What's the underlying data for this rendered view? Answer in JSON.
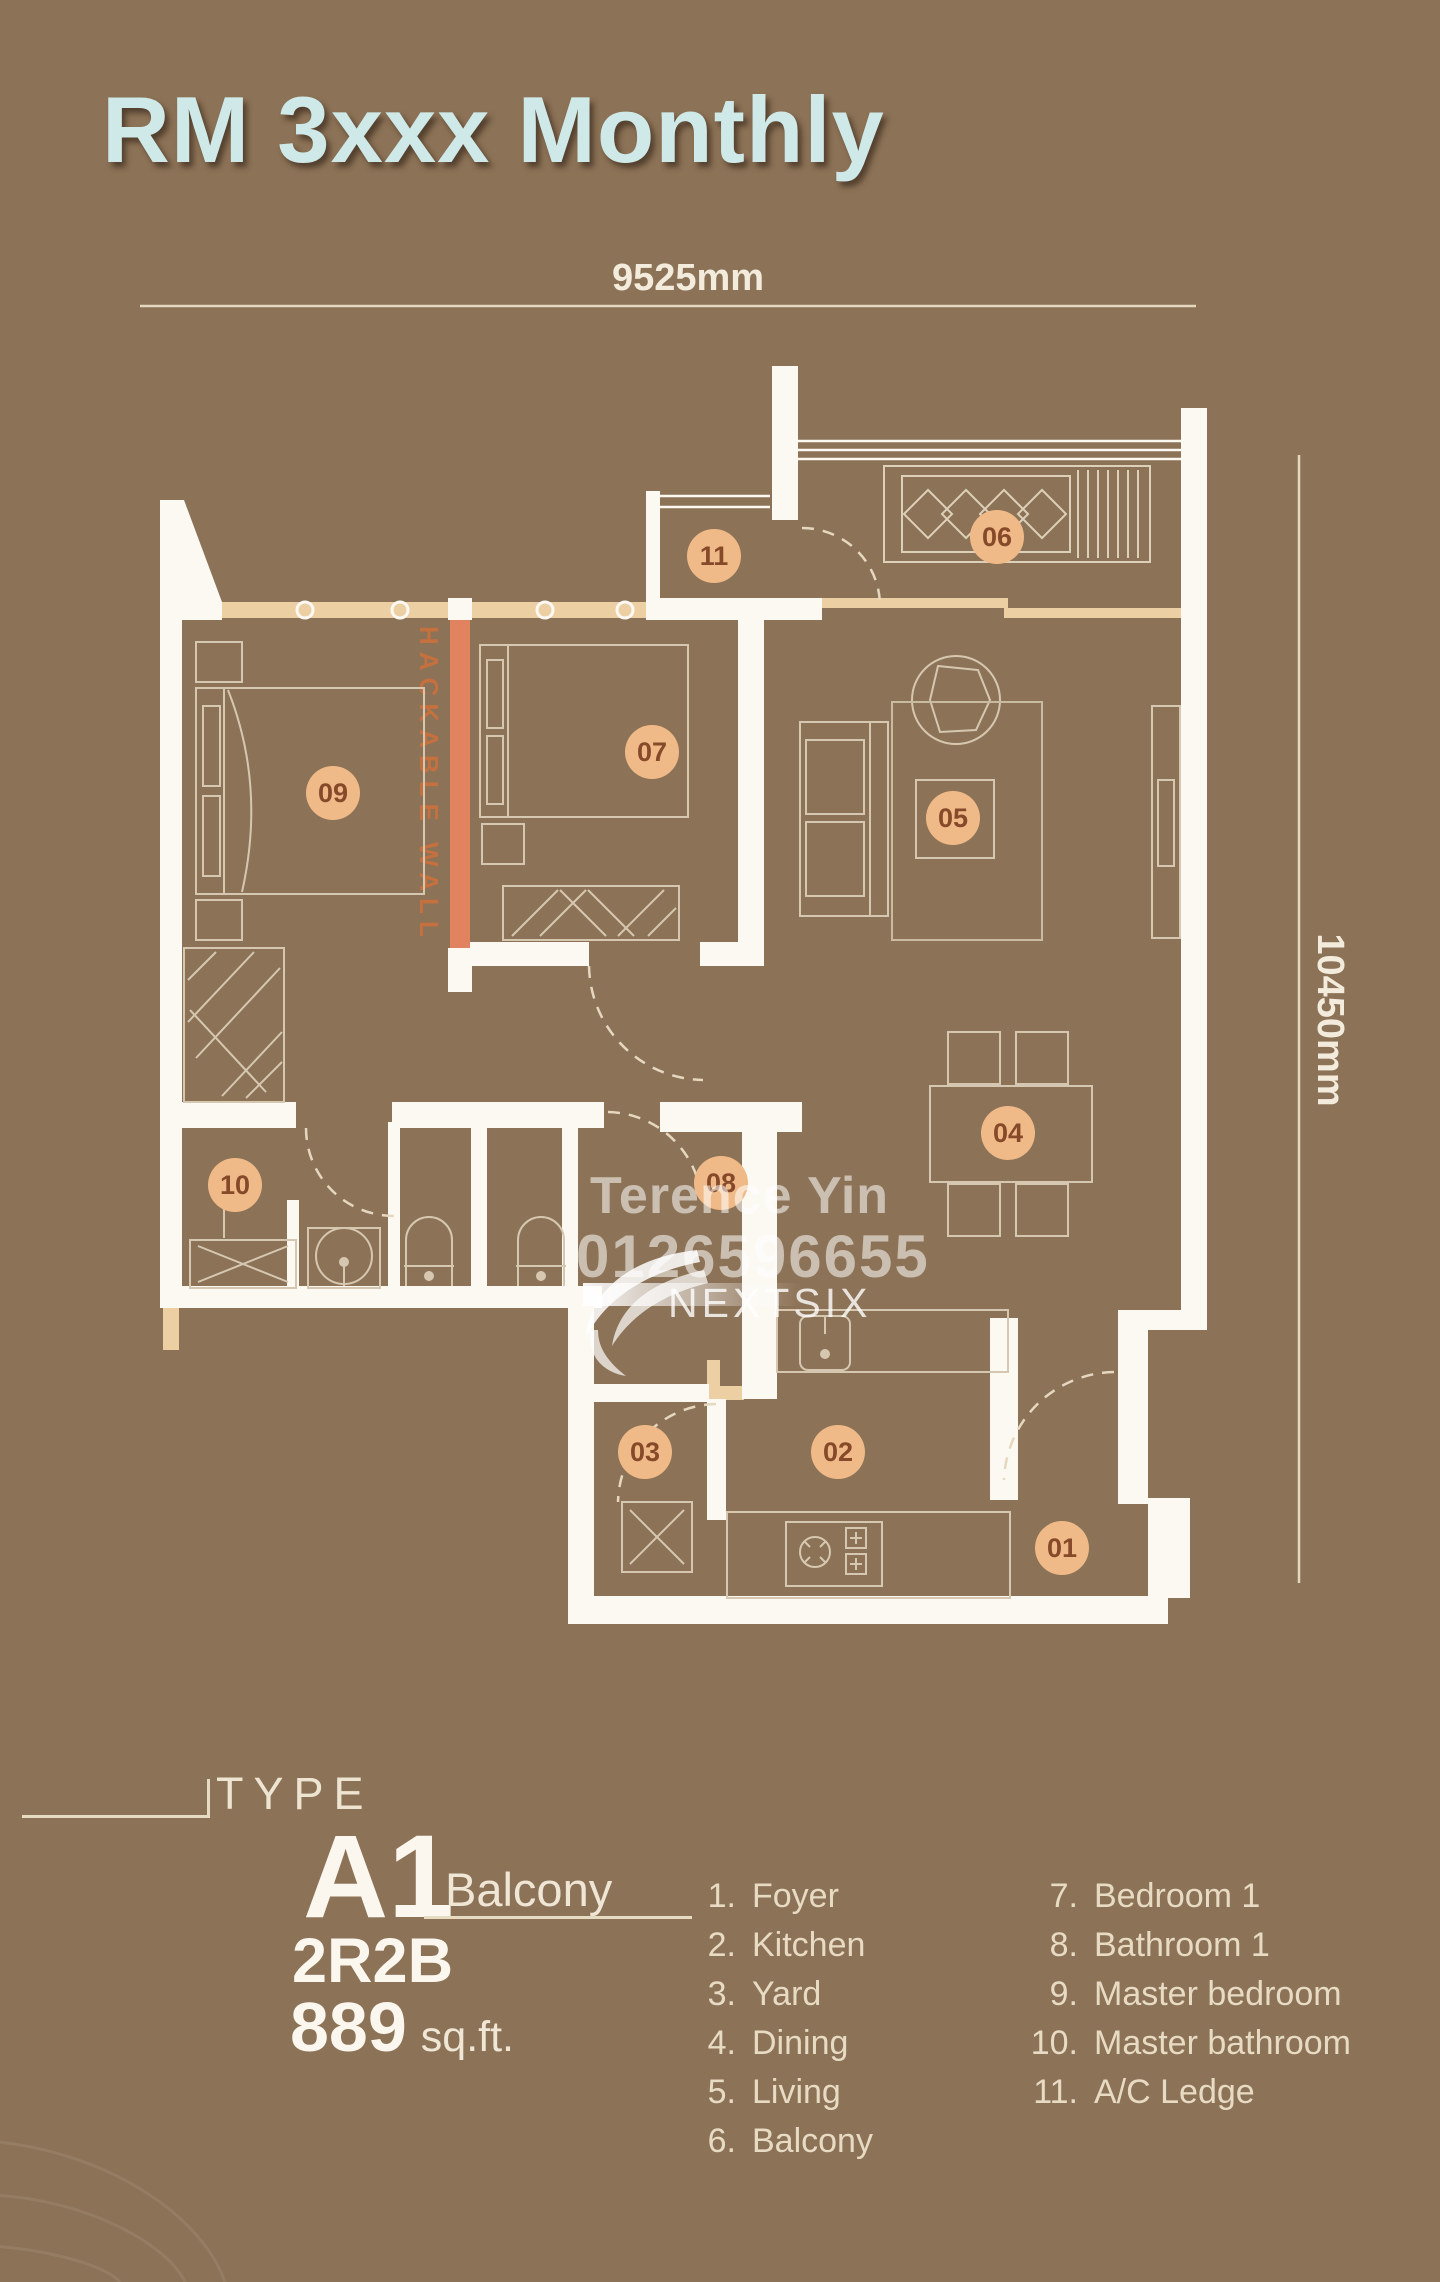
{
  "title": "RM 3xxx Monthly",
  "dimensions": {
    "top": "9525mm",
    "right": "10450mm"
  },
  "plan": {
    "hackable_wall": "HACKABLE WALL",
    "rooms": [
      {
        "num": "01",
        "x": 1062,
        "y": 1548
      },
      {
        "num": "02",
        "x": 838,
        "y": 1452
      },
      {
        "num": "03",
        "x": 645,
        "y": 1452
      },
      {
        "num": "04",
        "x": 1008,
        "y": 1133
      },
      {
        "num": "05",
        "x": 953,
        "y": 818
      },
      {
        "num": "06",
        "x": 997,
        "y": 537
      },
      {
        "num": "07",
        "x": 652,
        "y": 752
      },
      {
        "num": "08",
        "x": 721,
        "y": 1183
      },
      {
        "num": "09",
        "x": 333,
        "y": 793
      },
      {
        "num": "10",
        "x": 235,
        "y": 1185
      },
      {
        "num": "11",
        "x": 714,
        "y": 556
      }
    ]
  },
  "watermark": {
    "agent": "Terence Yin",
    "phone": "0126596655",
    "brand": "NEXTSIX"
  },
  "unit": {
    "type_label": "TYPE",
    "code": "A1",
    "variant": "Balcony",
    "layout": "2R2B",
    "area": "889",
    "area_unit": "sq.ft."
  },
  "legend": {
    "col1": [
      {
        "num": "1.",
        "label": "Foyer"
      },
      {
        "num": "2.",
        "label": "Kitchen"
      },
      {
        "num": "3.",
        "label": "Yard"
      },
      {
        "num": "4.",
        "label": "Dining"
      },
      {
        "num": "5.",
        "label": "Living"
      },
      {
        "num": "6.",
        "label": "Balcony"
      }
    ],
    "col2": [
      {
        "num": "7.",
        "label": "Bedroom 1"
      },
      {
        "num": "8.",
        "label": "Bathroom 1"
      },
      {
        "num": "9.",
        "label": "Master bedroom"
      },
      {
        "num": "10.",
        "label": "Master bathroom"
      },
      {
        "num": "11.",
        "label": "A/C Ledge"
      }
    ]
  }
}
